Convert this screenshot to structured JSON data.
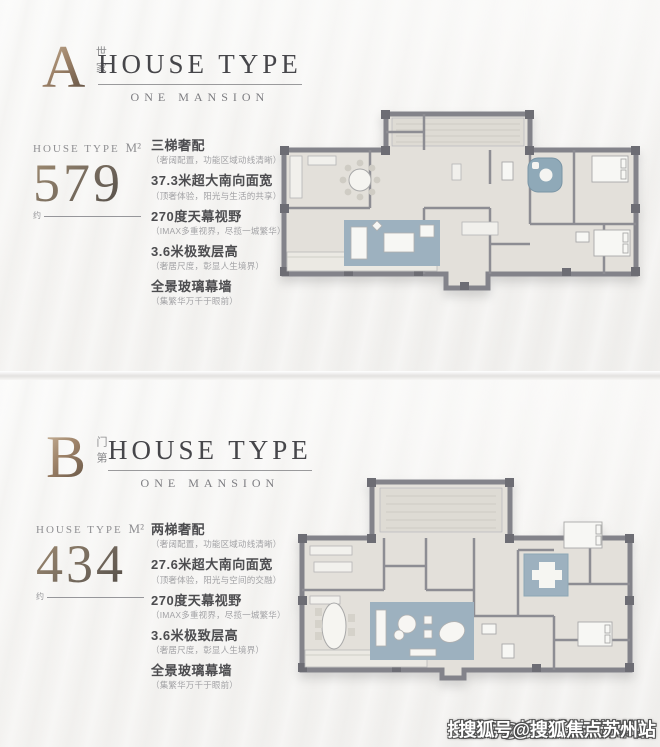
{
  "page": {
    "watermark": "搜狐号@搜狐焦点苏州站"
  },
  "panels": [
    {
      "letter": "A",
      "letter_cn": "世家",
      "title": "HOUSE TYPE",
      "subtitle": "ONE MANSION",
      "area_label": "HOUSE TYPE",
      "area_unit": "M²",
      "area_value": "579",
      "approx": "约",
      "features": [
        {
          "title": "三梯奢配",
          "desc": "（奢阔配置，功能区域动线清晰）"
        },
        {
          "title": "37.3米超大南向面宽",
          "desc": "（顶奢体验，阳光与生活的共享）"
        },
        {
          "title": "270度天幕视野",
          "desc": "（IMAX多重视界，尽揽一城繁华）"
        },
        {
          "title": "3.6米极致层高",
          "desc": "（奢居尺度，彰显人生境界）"
        },
        {
          "title": "全景玻璃幕墙",
          "desc": "（集繁华万千于眼前）"
        }
      ]
    },
    {
      "letter": "B",
      "letter_cn": "门第",
      "title": "HOUSE TYPE",
      "subtitle": "ONE MANSION",
      "area_label": "HOUSE TYPE",
      "area_unit": "M²",
      "area_value": "434",
      "approx": "约",
      "features": [
        {
          "title": "两梯奢配",
          "desc": "（奢阔配置，功能区域动线清晰）"
        },
        {
          "title": "27.6米超大南向面宽",
          "desc": "（顶奢体验，阳光与空间的交融）"
        },
        {
          "title": "270度天幕视野",
          "desc": "（IMAX多重视界，尽揽一城繁华）"
        },
        {
          "title": "3.6米极致层高",
          "desc": "（奢居尺度，彰显人生境界）"
        },
        {
          "title": "全景玻璃幕墙",
          "desc": "（集繁华万千于眼前）"
        }
      ]
    }
  ]
}
